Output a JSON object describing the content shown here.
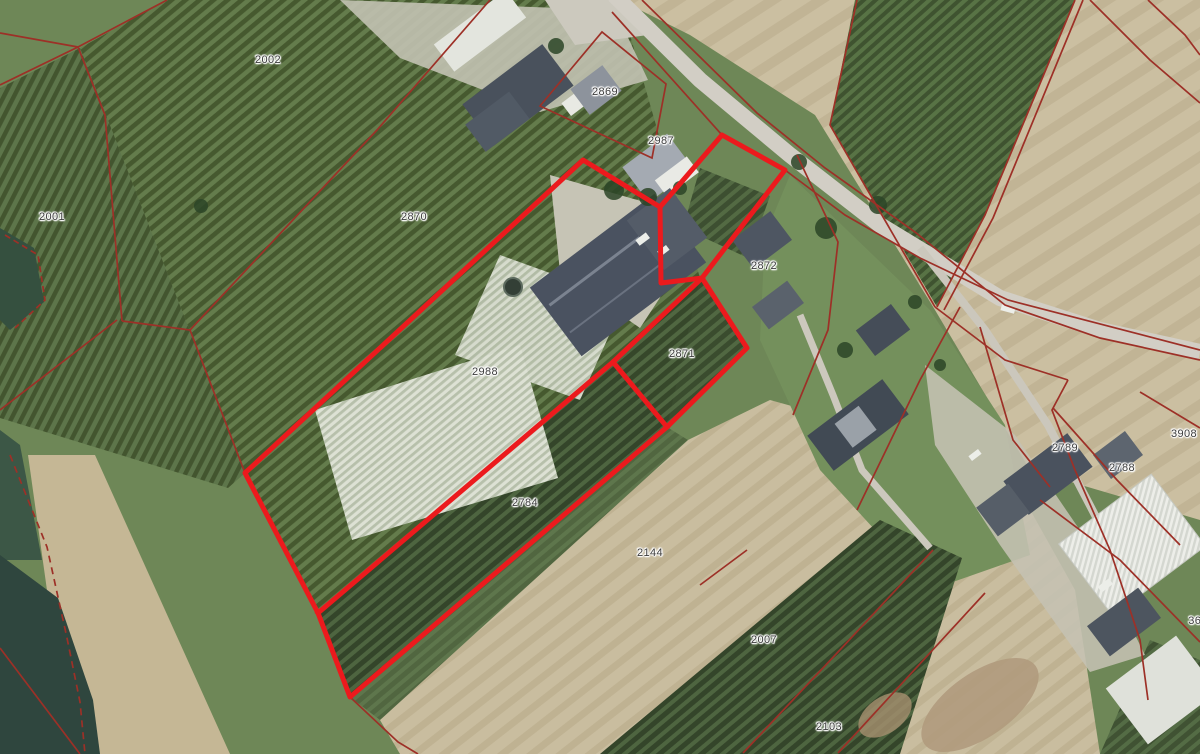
{
  "map": {
    "kind": "aerial-cadastral-map",
    "selection_outline_color": "#ec1a1d",
    "parcel_line_color": "#9d3027"
  },
  "labels": {
    "p2002": "2002",
    "p2001": "2001",
    "p2870": "2870",
    "p2869": "2869",
    "p2987": "2987",
    "p2872": "2872",
    "p2871": "2871",
    "p2988": "2988",
    "p2784": "2784",
    "p2144": "2144",
    "p2789": "2789",
    "p2788": "2788",
    "p3908": "3908",
    "p2007": "2007",
    "p2103": "2103",
    "p369": "369"
  }
}
